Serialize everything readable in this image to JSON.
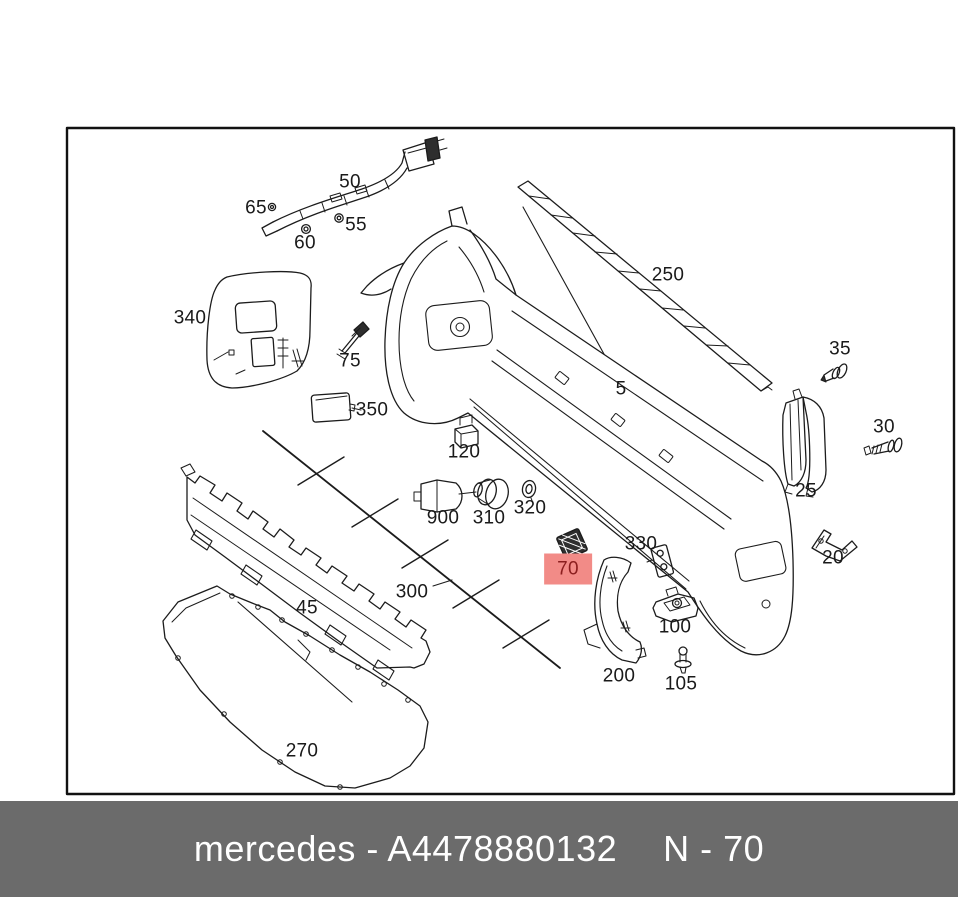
{
  "footer": {
    "brand_part": "mercedes - A4478880132",
    "sheet_ref": "N - 70"
  },
  "colors": {
    "highlight_bg": "#F28B87",
    "highlight_text": "#8B1E1E",
    "footer_bg": "#6B6B6B",
    "footer_text": "#FFFFFF",
    "line": "#1C1C1C",
    "canvas": "#FFFFFF"
  },
  "diagram": {
    "kind": "exploded-parts-diagram",
    "subject": "rear bumper assembly",
    "highlighted_part": "70",
    "parts": [
      {
        "label": "50"
      },
      {
        "label": "65"
      },
      {
        "label": "60"
      },
      {
        "label": "55"
      },
      {
        "label": "340"
      },
      {
        "label": "75"
      },
      {
        "label": "350"
      },
      {
        "label": "250"
      },
      {
        "label": "5"
      },
      {
        "label": "35"
      },
      {
        "label": "30"
      },
      {
        "label": "25"
      },
      {
        "label": "120"
      },
      {
        "label": "900"
      },
      {
        "label": "310"
      },
      {
        "label": "320"
      },
      {
        "label": "70",
        "highlighted": true
      },
      {
        "label": "330"
      },
      {
        "label": "300"
      },
      {
        "label": "45"
      },
      {
        "label": "200"
      },
      {
        "label": "100"
      },
      {
        "label": "105"
      },
      {
        "label": "270"
      },
      {
        "label": "20"
      }
    ]
  }
}
